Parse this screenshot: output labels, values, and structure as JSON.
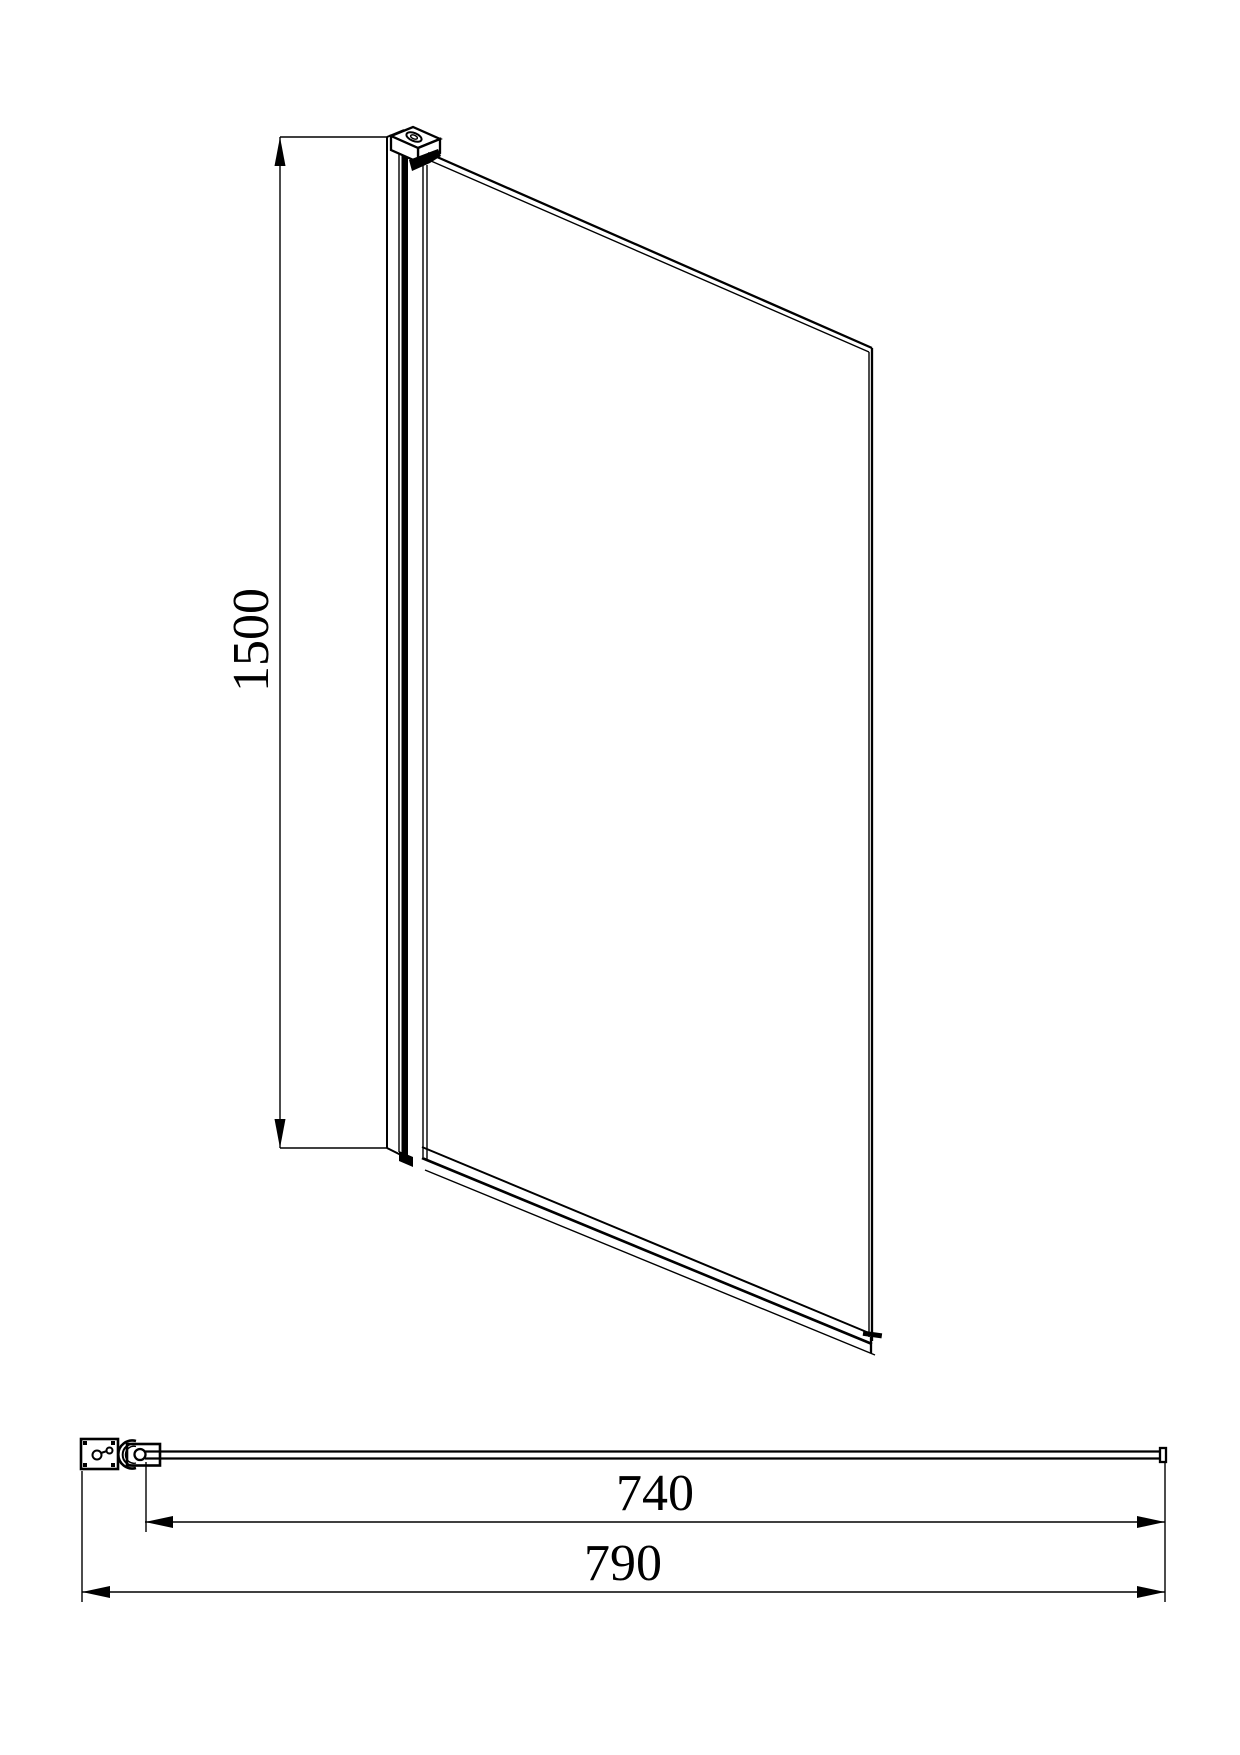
{
  "front_view": {
    "height_dimension": {
      "label": "1500"
    }
  },
  "plan_view": {
    "glass_width_dimension": {
      "label": "740"
    },
    "overall_width_dimension": {
      "label": "790"
    }
  },
  "colors": {
    "line": "#000000",
    "background": "#ffffff"
  }
}
